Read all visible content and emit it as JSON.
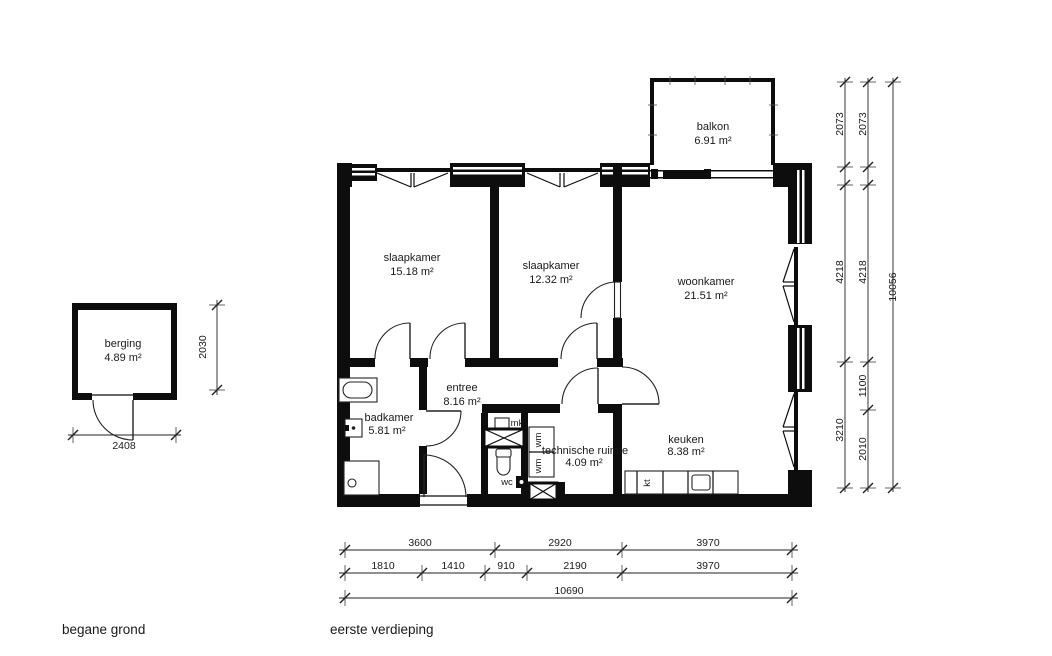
{
  "captions": {
    "left": "begane grond",
    "right": "eerste verdieping"
  },
  "rooms": {
    "berging": {
      "name": "berging",
      "area": "4.89 m²"
    },
    "slaapkamer_1": {
      "name": "slaapkamer",
      "area": "15.18 m²"
    },
    "slaapkamer_2": {
      "name": "slaapkamer",
      "area": "12.32 m²"
    },
    "woonkamer": {
      "name": "woonkamer",
      "area": "21.51 m²"
    },
    "balkon": {
      "name": "balkon",
      "area": "6.91 m²"
    },
    "badkamer": {
      "name": "badkamer",
      "area": "5.81 m²"
    },
    "entree": {
      "name": "entree",
      "area": "8.16 m²"
    },
    "technische_ruimte": {
      "name": "technische ruimte",
      "area": "4.09 m²"
    },
    "keuken": {
      "name": "keuken",
      "area": "8.38 m²"
    },
    "wc": {
      "name": "wc"
    }
  },
  "fixture_labels": {
    "mk": "mk",
    "wm_top": "wm",
    "wm_bottom": "wm",
    "kt": "kt"
  },
  "dimensions": {
    "berging_width": "2408",
    "berging_height": "2030",
    "right_inner": [
      "2073",
      "4218",
      "3210"
    ],
    "right_middle": [
      "2073",
      "4218",
      "1100",
      "2010"
    ],
    "right_total": "10056",
    "bottom_row1": [
      "3600",
      "2920",
      "3970"
    ],
    "bottom_row2": [
      "1810",
      "1410",
      "910",
      "2190",
      "3970"
    ],
    "bottom_total": "10690"
  }
}
